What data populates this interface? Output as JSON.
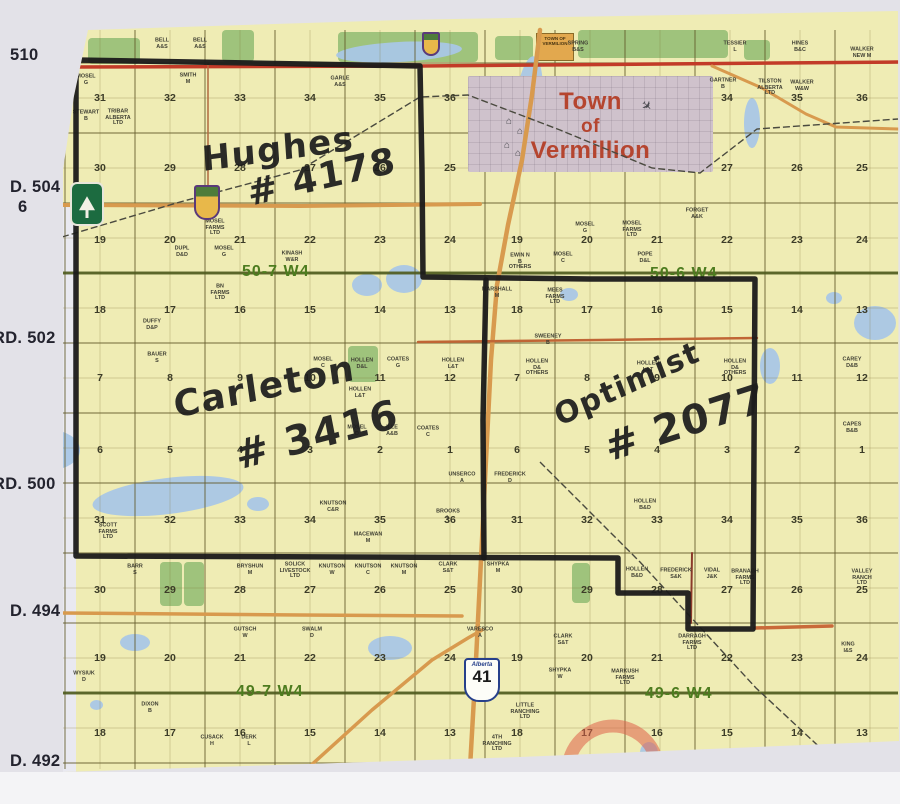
{
  "photo": {
    "margin_color": "#e3e2e8",
    "paper_color": "#efecb4",
    "bottom_strip_color": "#f4f4f6"
  },
  "margin_labels": [
    {
      "text": "510",
      "x": 10,
      "y": 46
    },
    {
      "text": "D. 504",
      "x": 10,
      "y": 178
    },
    {
      "text": "6",
      "x": 18,
      "y": 198
    },
    {
      "text": "RD. 502",
      "x": -7,
      "y": 329
    },
    {
      "text": "RD. 500",
      "x": -7,
      "y": 475
    },
    {
      "text": "D. 494",
      "x": 10,
      "y": 602
    },
    {
      "text": "D. 492",
      "x": 10,
      "y": 752
    }
  ],
  "township_labels": [
    {
      "text": "50-7 W4",
      "x": 242,
      "y": 263
    },
    {
      "text": "50-6 W4",
      "x": 650,
      "y": 265
    },
    {
      "text": "49-7 W4",
      "x": 236,
      "y": 683
    },
    {
      "text": "49-6 W4",
      "x": 645,
      "y": 685
    }
  ],
  "annotations": [
    {
      "text": "Hughes",
      "x": 202,
      "y": 140,
      "size": 34,
      "rot": -8
    },
    {
      "text": "# 4178",
      "x": 248,
      "y": 174,
      "size": 36,
      "rot": -13
    },
    {
      "text": "Carleton",
      "x": 174,
      "y": 386,
      "size": 36,
      "rot": -12
    },
    {
      "text": "# 3416",
      "x": 236,
      "y": 434,
      "size": 40,
      "rot": -15
    },
    {
      "text": "Optimist",
      "x": 556,
      "y": 400,
      "size": 30,
      "rot": -25
    },
    {
      "text": "# 2077",
      "x": 606,
      "y": 426,
      "size": 40,
      "rot": -18
    }
  ],
  "town": {
    "lines": [
      "Town",
      "of",
      "Vermillion"
    ],
    "x": 468,
    "y": 76,
    "w": 245,
    "h": 96
  },
  "town_of_box": {
    "text": "TOWN OF VERMILION",
    "x": 536,
    "y": 33,
    "w": 38,
    "h": 28
  },
  "highway41_shield": {
    "banner": "Alberta",
    "number": "41",
    "x": 464,
    "y": 658
  },
  "buildings": [
    [
      506,
      116
    ],
    [
      517,
      126
    ],
    [
      504,
      140
    ],
    [
      515,
      148
    ]
  ],
  "airplane": {
    "x": 641,
    "y": 98
  },
  "sections": {
    "cols_r7": [
      100,
      170,
      240,
      310,
      380,
      450
    ],
    "cols_r6": [
      517,
      587,
      657,
      727,
      797,
      862
    ],
    "rows": [
      {
        "y": 98,
        "r7": [
          31,
          32,
          33,
          34,
          35,
          36
        ],
        "r6": [
          null,
          null,
          null,
          34,
          35,
          36
        ]
      },
      {
        "y": 168,
        "r7": [
          30,
          29,
          28,
          27,
          26,
          25
        ],
        "r6": [
          null,
          null,
          null,
          27,
          26,
          25
        ]
      },
      {
        "y": 240,
        "r7": [
          19,
          20,
          21,
          22,
          23,
          24
        ],
        "r6": [
          19,
          20,
          21,
          22,
          23,
          24
        ]
      },
      {
        "y": 310,
        "r7": [
          18,
          17,
          16,
          15,
          14,
          13
        ],
        "r6": [
          18,
          17,
          16,
          15,
          14,
          13
        ]
      },
      {
        "y": 378,
        "r7": [
          7,
          8,
          9,
          10,
          11,
          12
        ],
        "r6": [
          7,
          8,
          9,
          10,
          11,
          12
        ]
      },
      {
        "y": 450,
        "r7": [
          6,
          5,
          4,
          3,
          2,
          1
        ],
        "r6": [
          6,
          5,
          4,
          3,
          2,
          1
        ]
      },
      {
        "y": 520,
        "r7": [
          31,
          32,
          33,
          34,
          35,
          36
        ],
        "r6": [
          31,
          32,
          33,
          34,
          35,
          36
        ]
      },
      {
        "y": 590,
        "r7": [
          30,
          29,
          28,
          27,
          26,
          25
        ],
        "r6": [
          30,
          29,
          28,
          27,
          26,
          25
        ]
      },
      {
        "y": 658,
        "r7": [
          19,
          20,
          21,
          22,
          23,
          24
        ],
        "r6": [
          19,
          20,
          21,
          22,
          23,
          24
        ]
      },
      {
        "y": 733,
        "r7": [
          18,
          17,
          16,
          15,
          14,
          13
        ],
        "r6": [
          18,
          17,
          16,
          15,
          14,
          13
        ]
      }
    ]
  },
  "owners": [
    {
      "t": "BELL\nA&S",
      "x": 162,
      "y": 44
    },
    {
      "t": "BELL\nA&S",
      "x": 200,
      "y": 44
    },
    {
      "t": "SPRING\nB&S",
      "x": 578,
      "y": 47
    },
    {
      "t": "TESSIER\nL",
      "x": 735,
      "y": 47
    },
    {
      "t": "HINES\nB&C",
      "x": 800,
      "y": 47
    },
    {
      "t": "WALKER\nNEW M",
      "x": 862,
      "y": 53
    },
    {
      "t": "MOSEL\nG",
      "x": 86,
      "y": 80
    },
    {
      "t": "SMITH\nM",
      "x": 188,
      "y": 79
    },
    {
      "t": "GARLE\nA&S",
      "x": 340,
      "y": 82
    },
    {
      "t": "GARTNER\nB",
      "x": 723,
      "y": 84
    },
    {
      "t": "TILSTON\nALBERTA\nLTD",
      "x": 770,
      "y": 88
    },
    {
      "t": "WALKER\nW&W",
      "x": 802,
      "y": 86
    },
    {
      "t": "STEWART\nB",
      "x": 86,
      "y": 116
    },
    {
      "t": "TRIBAR\nALBERTA\nLTD",
      "x": 118,
      "y": 118
    },
    {
      "t": "MOSEL\nFARMS\nLTD",
      "x": 215,
      "y": 228
    },
    {
      "t": "DUPL\nD&D",
      "x": 182,
      "y": 252
    },
    {
      "t": "MOSEL\nG",
      "x": 224,
      "y": 252
    },
    {
      "t": "KINASH\nW&R",
      "x": 292,
      "y": 257
    },
    {
      "t": "BN\nFARMS\nLTD",
      "x": 220,
      "y": 293
    },
    {
      "t": "FORGET\nA&K",
      "x": 697,
      "y": 214
    },
    {
      "t": "MOSEL\nG",
      "x": 585,
      "y": 228
    },
    {
      "t": "MOSEL\nFARMS\nLTD",
      "x": 632,
      "y": 230
    },
    {
      "t": "EWIN N\nB\nOTHERS",
      "x": 520,
      "y": 262
    },
    {
      "t": "MOSEL\nC",
      "x": 563,
      "y": 258
    },
    {
      "t": "POPE\nD&L",
      "x": 645,
      "y": 258
    },
    {
      "t": "DUFFY\nD&P",
      "x": 152,
      "y": 325
    },
    {
      "t": "BAUER\nS",
      "x": 157,
      "y": 358
    },
    {
      "t": "MARSHALL\nM",
      "x": 497,
      "y": 293
    },
    {
      "t": "MEES\nFARMS\nLTD",
      "x": 555,
      "y": 297
    },
    {
      "t": "SWEENEY\nB",
      "x": 548,
      "y": 340
    },
    {
      "t": "MOSEL\nC",
      "x": 323,
      "y": 363
    },
    {
      "t": "HOLLEN\nD&L",
      "x": 362,
      "y": 364
    },
    {
      "t": "COATES\nG",
      "x": 398,
      "y": 363
    },
    {
      "t": "HOLLEN\nL&T",
      "x": 453,
      "y": 364
    },
    {
      "t": "HOLLEN\nD&\nOTHERS",
      "x": 537,
      "y": 368
    },
    {
      "t": "HOLLEN\nL&T",
      "x": 648,
      "y": 367
    },
    {
      "t": "HOLLEN\nD&\nOTHERS",
      "x": 735,
      "y": 368
    },
    {
      "t": "HOLLEN\nL&T",
      "x": 360,
      "y": 393
    },
    {
      "t": "MOSEL\nD",
      "x": 357,
      "y": 431
    },
    {
      "t": "ILLE\nA&B",
      "x": 392,
      "y": 431
    },
    {
      "t": "COATES\nC",
      "x": 428,
      "y": 432
    },
    {
      "t": "CAREY\nD&B",
      "x": 852,
      "y": 363
    },
    {
      "t": "CAPES\nB&B",
      "x": 852,
      "y": 428
    },
    {
      "t": "UNSERCO\nA",
      "x": 462,
      "y": 478
    },
    {
      "t": "FREDERICK\nD",
      "x": 510,
      "y": 478
    },
    {
      "t": "KNUTSON\nC&R",
      "x": 333,
      "y": 507
    },
    {
      "t": "BROOKS\nL",
      "x": 448,
      "y": 515
    },
    {
      "t": "HOLLEN\nB&D",
      "x": 645,
      "y": 505
    },
    {
      "t": "SCOTT\nFARMS\nLTD",
      "x": 108,
      "y": 532
    },
    {
      "t": "MACEWAN\nM",
      "x": 368,
      "y": 538
    },
    {
      "t": "BARR\nS",
      "x": 135,
      "y": 570
    },
    {
      "t": "BRYSHUN\nM",
      "x": 250,
      "y": 570
    },
    {
      "t": "SOLICK\nLIVESTOCK\nLTD",
      "x": 295,
      "y": 571
    },
    {
      "t": "KNUTSON\nW",
      "x": 332,
      "y": 570
    },
    {
      "t": "KNUTSON\nC",
      "x": 368,
      "y": 570
    },
    {
      "t": "KNUTSON\nM",
      "x": 404,
      "y": 570
    },
    {
      "t": "CLARK\nS&T",
      "x": 448,
      "y": 568
    },
    {
      "t": "SHYPKA\nM",
      "x": 498,
      "y": 568
    },
    {
      "t": "HOLLEN\nB&D",
      "x": 637,
      "y": 573
    },
    {
      "t": "FREDERICK\nS&K",
      "x": 676,
      "y": 574
    },
    {
      "t": "VIDAL\nJ&K",
      "x": 712,
      "y": 574
    },
    {
      "t": "BRANAGH\nFARMS\nLTD",
      "x": 745,
      "y": 578
    },
    {
      "t": "VALLEY\nRANCH\nLTD",
      "x": 862,
      "y": 578
    },
    {
      "t": "GUTSCH\nW",
      "x": 245,
      "y": 633
    },
    {
      "t": "SWALM\nD",
      "x": 312,
      "y": 633
    },
    {
      "t": "VARESCO\nA",
      "x": 480,
      "y": 633
    },
    {
      "t": "CLARK\nS&T",
      "x": 563,
      "y": 640
    },
    {
      "t": "DARRAGH\nFARMS\nLTD",
      "x": 692,
      "y": 643
    },
    {
      "t": "KING\nI&S",
      "x": 848,
      "y": 648
    },
    {
      "t": "SHYPKA\nW",
      "x": 560,
      "y": 674
    },
    {
      "t": "MARKUSH\nFARMS\nLTD",
      "x": 625,
      "y": 678
    },
    {
      "t": "LITTLE\nRANCHING\nLTD",
      "x": 525,
      "y": 712
    },
    {
      "t": "4TH\nRANCHING\nLTD",
      "x": 497,
      "y": 744
    },
    {
      "t": "WYSIUK\nD",
      "x": 84,
      "y": 677
    },
    {
      "t": "DIXON\nB",
      "x": 150,
      "y": 708
    },
    {
      "t": "CUSACK\nH",
      "x": 212,
      "y": 741
    },
    {
      "t": "DERK\nL",
      "x": 249,
      "y": 741
    }
  ],
  "boundary": {
    "outer": [
      [
        76,
        60
      ],
      [
        250,
        63
      ],
      [
        420,
        66
      ],
      [
        422,
        170
      ],
      [
        423,
        277
      ],
      [
        590,
        279
      ],
      [
        755,
        279
      ],
      [
        754,
        450
      ],
      [
        753,
        629
      ],
      [
        688,
        629
      ],
      [
        688,
        593
      ],
      [
        618,
        593
      ],
      [
        618,
        558
      ],
      [
        350,
        557
      ],
      [
        76,
        556
      ],
      [
        76,
        300
      ],
      [
        76,
        60
      ]
    ],
    "divider": [
      [
        486,
        280
      ],
      [
        483,
        420
      ],
      [
        484,
        558
      ]
    ],
    "color": "#1a1a1a",
    "width": 5.5
  },
  "roads": [
    {
      "pts": [
        [
          62,
          67
        ],
        [
          420,
          66
        ],
        [
          898,
          62
        ]
      ],
      "c": "#c23b28",
      "w": 3.5
    },
    {
      "pts": [
        [
          62,
          205
        ],
        [
          300,
          206
        ],
        [
          480,
          204
        ]
      ],
      "c": "#d89a4e",
      "w": 4
    },
    {
      "pts": [
        [
          540,
          30
        ],
        [
          532,
          95
        ],
        [
          522,
          160
        ],
        [
          508,
          225
        ],
        [
          497,
          285
        ],
        [
          491,
          360
        ],
        [
          487,
          440
        ],
        [
          483,
          520
        ],
        [
          479,
          600
        ],
        [
          475,
          680
        ],
        [
          470,
          768
        ]
      ],
      "c": "#d89a4e",
      "w": 4.5
    },
    {
      "pts": [
        [
          62,
          613
        ],
        [
          300,
          615
        ],
        [
          462,
          616
        ]
      ],
      "c": "#d89a4e",
      "w": 3.5
    },
    {
      "pts": [
        [
          755,
          628
        ],
        [
          832,
          626
        ]
      ],
      "c": "#c96a3a",
      "w": 3.5
    },
    {
      "pts": [
        [
          712,
          66
        ],
        [
          762,
          88
        ],
        [
          806,
          114
        ],
        [
          836,
          127
        ],
        [
          898,
          129
        ]
      ],
      "c": "#d89a4e",
      "w": 3
    },
    {
      "pts": [
        [
          308,
          768
        ],
        [
          372,
          710
        ],
        [
          432,
          660
        ],
        [
          468,
          638
        ],
        [
          482,
          630
        ]
      ],
      "c": "#d89a4e",
      "w": 3.5
    },
    {
      "pts": [
        [
          418,
          342
        ],
        [
          600,
          340
        ],
        [
          757,
          338
        ]
      ],
      "c": "#c06535",
      "w": 2.5
    },
    {
      "pts": [
        [
          208,
          63
        ],
        [
          208,
          203
        ]
      ],
      "c": "#b06a40",
      "w": 1.5
    },
    {
      "pts": [
        [
          692,
          553
        ],
        [
          691,
          623
        ]
      ],
      "c": "#8b3a2a",
      "w": 2
    }
  ],
  "railways": [
    {
      "pts": [
        [
          62,
          237
        ],
        [
          180,
          202
        ],
        [
          300,
          170
        ],
        [
          420,
          97
        ],
        [
          468,
          95
        ],
        [
          560,
          130
        ],
        [
          652,
          168
        ],
        [
          700,
          173
        ],
        [
          757,
          129
        ],
        [
          898,
          119
        ]
      ]
    },
    {
      "pts": [
        [
          540,
          462
        ],
        [
          640,
          562
        ],
        [
          756,
          688
        ],
        [
          842,
          768
        ]
      ]
    }
  ],
  "township_lines": {
    "ys": [
      273,
      693
    ],
    "color": "#4e5c1e"
  },
  "grid": {
    "x0": 65,
    "y0": 63,
    "step": 35,
    "x_min": 62,
    "x_max": 898,
    "y_min": 30,
    "y_max": 769,
    "quarter_color": "rgba(130,118,60,0.40)",
    "section_color": "rgba(100,92,45,0.72)"
  },
  "lakes": [
    [
      336,
      42,
      126,
      20,
      -3
    ],
    [
      20,
      430,
      60,
      40,
      0
    ],
    [
      92,
      478,
      152,
      36,
      -7
    ],
    [
      247,
      497,
      22,
      14,
      0
    ],
    [
      352,
      274,
      30,
      22,
      0
    ],
    [
      386,
      265,
      36,
      28,
      0
    ],
    [
      514,
      56,
      28,
      108,
      6
    ],
    [
      744,
      98,
      16,
      50,
      0
    ],
    [
      560,
      288,
      18,
      13,
      0
    ],
    [
      120,
      634,
      30,
      17,
      0
    ],
    [
      368,
      636,
      44,
      24,
      0
    ],
    [
      760,
      348,
      20,
      36,
      0
    ],
    [
      826,
      292,
      16,
      12,
      0
    ],
    [
      854,
      306,
      42,
      34,
      0
    ],
    [
      90,
      700,
      13,
      10,
      0
    ],
    [
      640,
      742,
      18,
      22,
      0
    ]
  ],
  "greens": [
    [
      88,
      38,
      52,
      26
    ],
    [
      222,
      30,
      32,
      32
    ],
    [
      338,
      32,
      140,
      30
    ],
    [
      495,
      36,
      38,
      24
    ],
    [
      578,
      30,
      150,
      28
    ],
    [
      744,
      40,
      26,
      20
    ],
    [
      348,
      346,
      30,
      36
    ],
    [
      160,
      562,
      22,
      44
    ],
    [
      184,
      562,
      20,
      44
    ],
    [
      572,
      563,
      18,
      40
    ]
  ],
  "pale_strip": [
    62,
    205,
    14,
    567
  ],
  "red_arc": {
    "cx": 613,
    "cy": 771,
    "r": 45,
    "color": "#df6148"
  },
  "park_badge": {
    "x": 70,
    "y": 182
  },
  "crest_619": {
    "x": 194,
    "y": 185
  },
  "crest_small": {
    "x": 422,
    "y": 32
  }
}
